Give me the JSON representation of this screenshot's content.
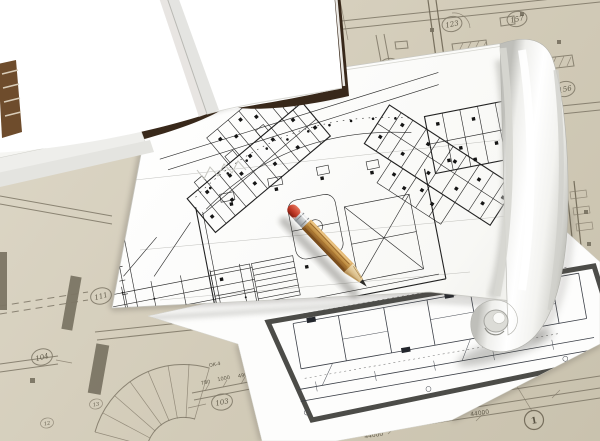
{
  "scene_objects": [
    {
      "name": "open-blank-book"
    },
    {
      "name": "rolled-floor-plan-sheet"
    },
    {
      "name": "bottom-plan-sheet"
    },
    {
      "name": "wooden-pencil"
    },
    {
      "name": "background-blueprint"
    }
  ],
  "colors": {
    "paper_tan": "#d4cdbb",
    "blueprint_line": "#7d7565",
    "sheet_white": "#ffffff",
    "frame_gray": "#4c4c48",
    "ink_black": "#1e1e1e",
    "book_cover_brown": "#38281a",
    "pencil_wood": "#c29145",
    "pencil_eraser_red": "#c23a28",
    "pencil_ferrule_silver": "#c7cacc",
    "graphite": "#2c2b27"
  },
  "background_plan": {
    "room_labels": [
      {
        "value": "123"
      },
      {
        "value": "157"
      },
      {
        "value": "124"
      },
      {
        "value": "156"
      },
      {
        "value": "111"
      },
      {
        "value": "104"
      },
      {
        "value": "103"
      },
      {
        "value": "13"
      },
      {
        "value": "12"
      }
    ],
    "grid_marker": {
      "value": "1"
    },
    "dimensions": [
      {
        "value": "44000"
      },
      {
        "value": "44000"
      },
      {
        "value": "780"
      },
      {
        "value": "1000"
      },
      {
        "value": "490"
      },
      {
        "value": "OK-4"
      }
    ]
  }
}
